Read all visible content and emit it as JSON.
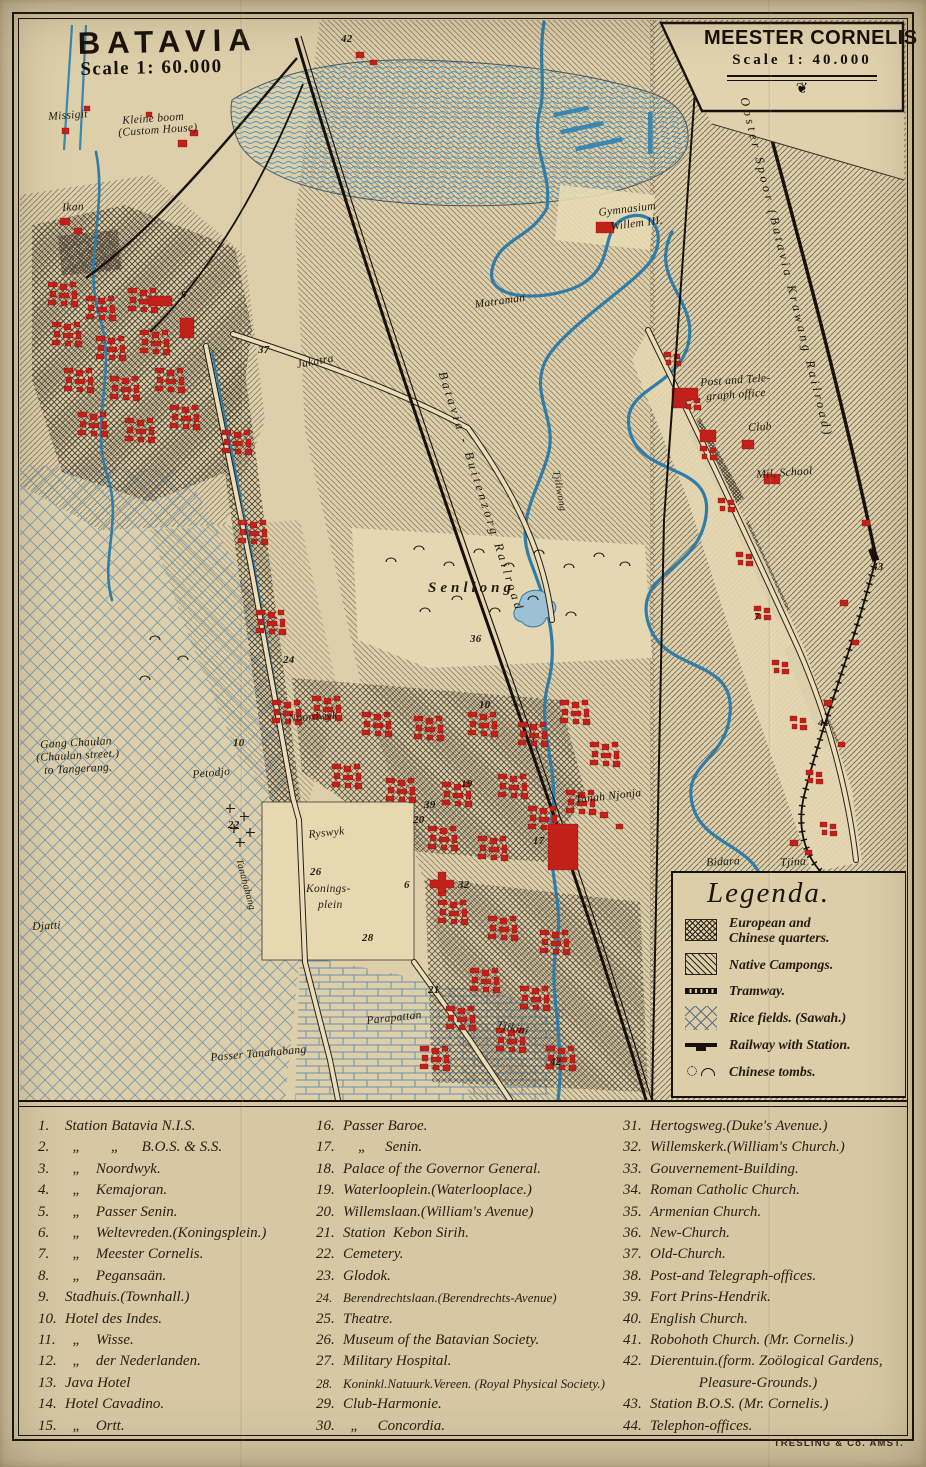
{
  "panels": {
    "batavia": {
      "title": "BATAVIA",
      "scale": "Scale 1: 60.000"
    },
    "meester_cornelis": {
      "title": "MEESTER CORNELIS",
      "scale": "Scale 1: 40.000",
      "ornament": "❦"
    }
  },
  "legend": {
    "title": "Legenda.",
    "items": [
      {
        "sym": "quarters",
        "label": "European and\nChinese quarters."
      },
      {
        "sym": "campongs",
        "label": "Native Campongs."
      },
      {
        "sym": "tramway",
        "label": "Tramway."
      },
      {
        "sym": "rice",
        "label": "Rice fields. (Sawah.)"
      },
      {
        "sym": "railway",
        "label": "Railway with Station."
      },
      {
        "sym": "tombs",
        "label": "Chinese tombs."
      }
    ]
  },
  "index": {
    "col1": [
      {
        "num": "1.",
        "label": "Station Batavia N.I.S."
      },
      {
        "num": "2.",
        "label": "  „        „      B.O.S. & S.S."
      },
      {
        "num": "3.",
        "label": "  „    Noordwyk."
      },
      {
        "num": "4.",
        "label": "  „    Kemajoran."
      },
      {
        "num": "5.",
        "label": "  „    Passer Senin."
      },
      {
        "num": "6.",
        "label": "  „    Weltevreden.(Koningsplein.)"
      },
      {
        "num": "7.",
        "label": "  „    Meester Cornelis."
      },
      {
        "num": "8.",
        "label": "  „    Pegansaän."
      },
      {
        "num": "9.",
        "label": "Stadhuis.(Townhall.)"
      },
      {
        "num": "10.",
        "label": "Hotel des Indes."
      },
      {
        "num": "11.",
        "label": "  „    Wisse."
      },
      {
        "num": "12.",
        "label": "  „    der Nederlanden."
      },
      {
        "num": "13.",
        "label": "Java Hotel"
      },
      {
        "num": "14.",
        "label": "Hotel Cavadino."
      },
      {
        "num": "15.",
        "label": "  „    Ortt."
      }
    ],
    "col2": [
      {
        "num": "16.",
        "label": "Passer Baroe."
      },
      {
        "num": "17.",
        "label": "    „     Senin."
      },
      {
        "num": "18.",
        "label": "Palace of the Governor General."
      },
      {
        "num": "19.",
        "label": "Waterlooplein.(Waterlooplace.)"
      },
      {
        "num": "20.",
        "label": "Willemslaan.(William's Avenue)"
      },
      {
        "num": "21.",
        "label": "Station  Kebon Sirih."
      },
      {
        "num": "22.",
        "label": "Cemetery."
      },
      {
        "num": "23.",
        "label": "Glodok."
      },
      {
        "num": "24.",
        "label": "Berendrechtslaan.(Berendrechts-Avenue)",
        "cls": "small"
      },
      {
        "num": "25.",
        "label": "Theatre."
      },
      {
        "num": "26.",
        "label": "Museum of the Batavian Society."
      },
      {
        "num": "27.",
        "label": "Military Hospital."
      },
      {
        "num": "28.",
        "label": "Koninkl.Natuurk.Vereen. (Royal Physical Society.)",
        "cls": "small"
      },
      {
        "num": "29.",
        "label": "Club-Harmonie."
      },
      {
        "num": "30.",
        "label": "  „     Concordia."
      }
    ],
    "col3": [
      {
        "num": "31.",
        "label": "Hertogsweg.(Duke's Avenue.)"
      },
      {
        "num": "32.",
        "label": "Willemskerk.(William's Church.)"
      },
      {
        "num": "33.",
        "label": "Gouvernement-Building."
      },
      {
        "num": "34.",
        "label": "Roman Catholic Church."
      },
      {
        "num": "35.",
        "label": "Armenian Church."
      },
      {
        "num": "36.",
        "label": "New-Church."
      },
      {
        "num": "37.",
        "label": "Old-Church."
      },
      {
        "num": "38.",
        "label": "Post-and Telegraph-offices."
      },
      {
        "num": "39.",
        "label": "Fort Prins-Hendrik."
      },
      {
        "num": "40.",
        "label": "English Church."
      },
      {
        "num": "41.",
        "label": "Robohoth Church. (Mr. Cornelis.)"
      },
      {
        "num": "42.",
        "label": "Dierentuin.(form. Zoölogical Gardens,\n             Pleasure-Grounds.)"
      },
      {
        "num": "43.",
        "label": "Station B.O.S. (Mr. Cornelis.)"
      },
      {
        "num": "44.",
        "label": "Telephon-offices."
      }
    ]
  },
  "map_labels": [
    {
      "text": "Missigit",
      "x": 48,
      "y": 112,
      "rot": -4
    },
    {
      "text": "Kleine boom",
      "x": 122,
      "y": 116,
      "rot": -4
    },
    {
      "text": "(Custom House)",
      "x": 118,
      "y": 128,
      "rot": -4
    },
    {
      "text": "Ikan",
      "x": 62,
      "y": 203,
      "rot": -3
    },
    {
      "text": "Jakatra",
      "x": 296,
      "y": 360,
      "rot": -10
    },
    {
      "text": "Senliong",
      "x": 428,
      "y": 581,
      "cls": "plc-sp"
    },
    {
      "text": "Noordwyk",
      "x": 288,
      "y": 714,
      "rot": -4
    },
    {
      "text": "Gang Chaulan",
      "x": 40,
      "y": 740,
      "rot": -3
    },
    {
      "text": "(Chaulan street.)",
      "x": 36,
      "y": 753,
      "rot": -3
    },
    {
      "text": "to Tangerang.",
      "x": 44,
      "y": 766,
      "rot": -3
    },
    {
      "text": "Petodjo",
      "x": 192,
      "y": 770,
      "rot": -5
    },
    {
      "text": "Djatti",
      "x": 32,
      "y": 922,
      "rot": -3
    },
    {
      "text": "Ryswyk",
      "x": 308,
      "y": 830,
      "rot": -6
    },
    {
      "text": "Konings-",
      "x": 306,
      "y": 884
    },
    {
      "text": "plein",
      "x": 318,
      "y": 900
    },
    {
      "text": "Tanahabang",
      "x": 243,
      "y": 858,
      "rot": 75,
      "cls": "plc-sm"
    },
    {
      "text": "Passer Tanahabang",
      "x": 210,
      "y": 1053,
      "rot": -5
    },
    {
      "text": "Parapattan",
      "x": 366,
      "y": 1016,
      "rot": -6
    },
    {
      "text": "Tjikini",
      "x": 498,
      "y": 1020,
      "rot": 12
    },
    {
      "text": "Tanah Njonja",
      "x": 575,
      "y": 795,
      "rot": -6
    },
    {
      "text": "Bidara",
      "x": 706,
      "y": 858,
      "rot": -3
    },
    {
      "text": "Tjina",
      "x": 780,
      "y": 858,
      "rot": -3
    },
    {
      "text": "Matraman",
      "x": 474,
      "y": 300,
      "rot": -8
    },
    {
      "text": "Gymnasium",
      "x": 598,
      "y": 208,
      "rot": -7
    },
    {
      "text": "Willem III.",
      "x": 610,
      "y": 222,
      "rot": -7
    },
    {
      "text": "Post and Tele-",
      "x": 700,
      "y": 378,
      "rot": -4
    },
    {
      "text": "graph office",
      "x": 706,
      "y": 392,
      "rot": -4
    },
    {
      "text": "Club",
      "x": 748,
      "y": 423,
      "rot": -3
    },
    {
      "text": "Mil. School",
      "x": 756,
      "y": 470,
      "rot": -4
    },
    {
      "text": "Tjiliwong",
      "x": 560,
      "y": 470,
      "rot": 80,
      "cls": "plc-sm"
    },
    {
      "text": "Batavia - Buitenzorg Railroad",
      "x": 448,
      "y": 370,
      "rot": 72,
      "cls": "rail-lbl"
    },
    {
      "text": "Ooster Spoor (Batavia Krawang Railroad)",
      "x": 750,
      "y": 96,
      "rot": 76,
      "cls": "rail-lbl"
    },
    {
      "text": "42",
      "x": 341,
      "y": 34,
      "cls": "num"
    },
    {
      "text": "9",
      "x": 181,
      "y": 290,
      "cls": "num"
    },
    {
      "text": "37",
      "x": 258,
      "y": 345,
      "cls": "num"
    },
    {
      "text": "24",
      "x": 283,
      "y": 655,
      "cls": "num"
    },
    {
      "text": "36",
      "x": 470,
      "y": 634,
      "cls": "num"
    },
    {
      "text": "10",
      "x": 479,
      "y": 700,
      "cls": "num"
    },
    {
      "text": "10",
      "x": 233,
      "y": 738,
      "cls": "num"
    },
    {
      "text": "22",
      "x": 228,
      "y": 820,
      "cls": "num"
    },
    {
      "text": "19",
      "x": 461,
      "y": 779,
      "cls": "num"
    },
    {
      "text": "39",
      "x": 424,
      "y": 800,
      "cls": "num"
    },
    {
      "text": "20",
      "x": 413,
      "y": 815,
      "cls": "num"
    },
    {
      "text": "17",
      "x": 533,
      "y": 836,
      "cls": "num"
    },
    {
      "text": "26",
      "x": 310,
      "y": 867,
      "cls": "num"
    },
    {
      "text": "6",
      "x": 404,
      "y": 880,
      "cls": "num"
    },
    {
      "text": "32",
      "x": 458,
      "y": 880,
      "cls": "num"
    },
    {
      "text": "28",
      "x": 362,
      "y": 933,
      "cls": "num"
    },
    {
      "text": "21",
      "x": 428,
      "y": 985,
      "cls": "num"
    },
    {
      "text": "42",
      "x": 550,
      "y": 1057,
      "cls": "num"
    },
    {
      "text": "7",
      "x": 754,
      "y": 612,
      "cls": "num"
    },
    {
      "text": "41",
      "x": 818,
      "y": 718,
      "cls": "num"
    },
    {
      "text": "43",
      "x": 872,
      "y": 562,
      "cls": "num"
    }
  ],
  "credit": "TRESLING & Co. AMST."
}
